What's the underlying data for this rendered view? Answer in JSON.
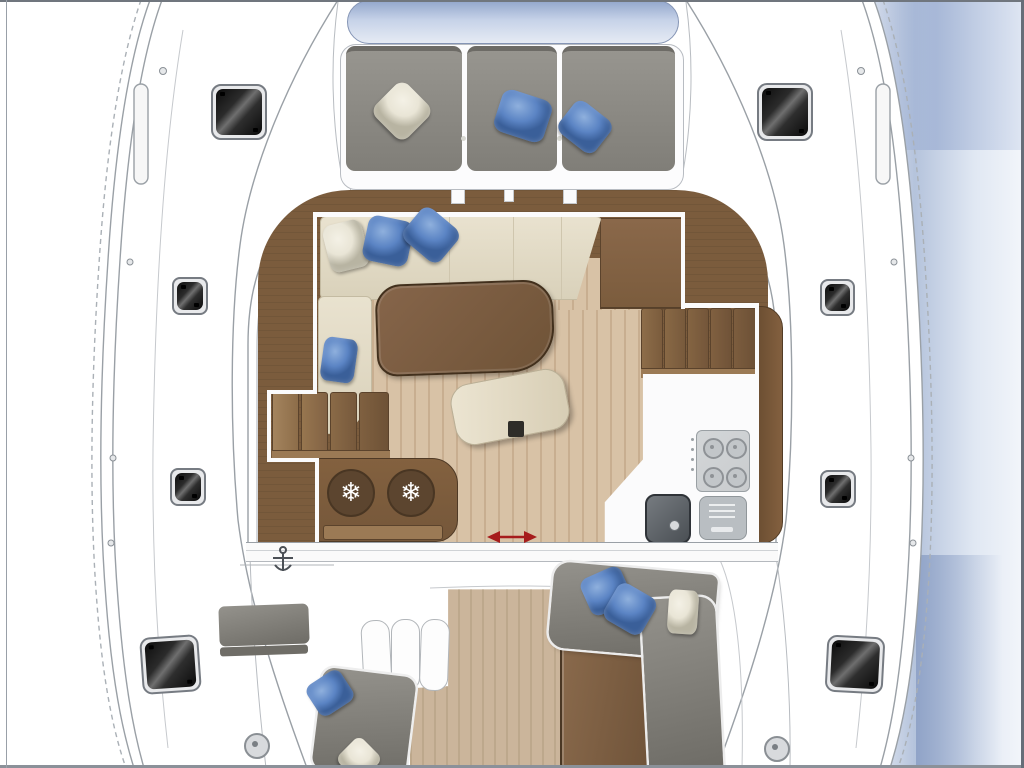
{
  "palette": {
    "white": "#ffffff",
    "line_gray": "#9aa0a6",
    "line_light": "#c6c9cd",
    "water_near": "#a8b9d6",
    "water_far": "#f2f5fa",
    "water_deep": "#8a9ec4",
    "pad_blue_dark": "#93a7cc",
    "pad_blue_light": "#e6ebf4",
    "cushion_gray_light": "#97958f",
    "cushion_gray_dark": "#807e78",
    "pillow_blue": "#5b84c4",
    "pillow_blue_hi": "#8fb0dd",
    "pillow_blue_dark": "#3a5f99",
    "pillow_cream": "#e9e5d6",
    "pillow_cream_dark": "#b8b4a2",
    "sofa_cream": "#e9e2cf",
    "sofa_cream_dark": "#d9d1ba",
    "walnut": "#7b5c3d",
    "walnut_dark": "#5b432c",
    "walnut_edge": "#42301d",
    "walnut_light": "#9b7a55",
    "maple": "#d8c2a6",
    "maple_stripe": "#c8ae90",
    "teak": "#cbb59b",
    "teak_stripe": "#bda88c",
    "counter_white": "#fbfbfc",
    "stove_gray": "#c9ccce",
    "appliance_gray": "#b9bec2",
    "sink_dark": "#4a4f54",
    "arrow_red": "#a61c1c",
    "hatch_frame": "#767b82",
    "gray_seat_light": "#94928c",
    "gray_seat_dark": "#6e6c66"
  },
  "icons": {
    "snowflake": "❄"
  },
  "plan": {
    "type": "catamaran-deck-floor-plan",
    "areas": {
      "bow": {
        "sunpad": "blue-sunpad",
        "bench_cushions": 3,
        "pillows": [
          "cream",
          "blue",
          "blue"
        ]
      },
      "salon": {
        "sofa": "cream-l-shaped-sofa",
        "sofa_pillows": [
          "cream",
          "blue",
          "blue",
          "blue"
        ],
        "table": "walnut-coffee-table",
        "ottoman": "curved-cream-bench",
        "fridge_symbols": 2,
        "galley_appliances": [
          "stove-4-burner",
          "oven",
          "sink"
        ],
        "stairs": [
          "port-companionway",
          "starboard-companionway"
        ],
        "door": "sliding-door-with-red-arrow"
      },
      "cockpit": {
        "sofa": "gray-l-shaped-sofa",
        "sofa_pillows": [
          "blue",
          "blue",
          "cream"
        ],
        "table": "walnut-cockpit-table",
        "steps": 3,
        "bench": "port-cockpit-bench",
        "seat_pillows": [
          "blue",
          "cream"
        ]
      },
      "hulls": {
        "port_hatches": 4,
        "starboard_hatches": 4,
        "deck_fittings": 2
      }
    }
  }
}
